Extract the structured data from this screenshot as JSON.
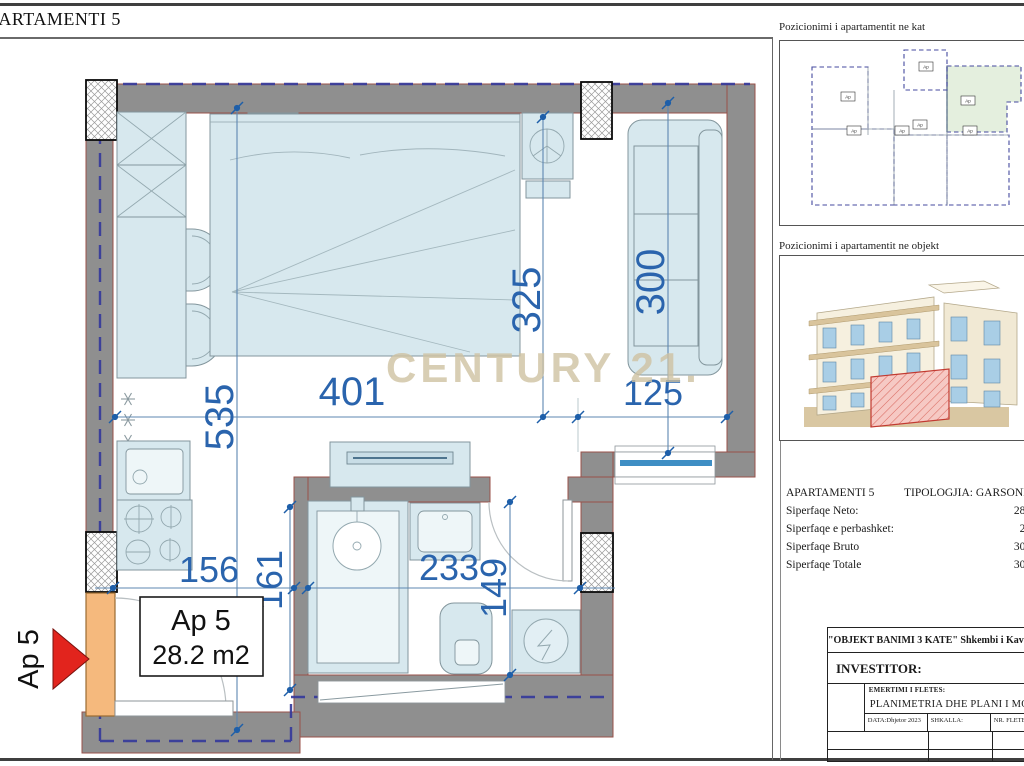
{
  "sheet": {
    "title": "APARTAMENTI 5"
  },
  "watermark": "CENTURY 21.",
  "colors": {
    "wall_gray": "#8f8f8f",
    "dimension_blue": "#2a64ad",
    "boundary_dash_blue": "#35399b",
    "door_orange": "#f5b97d",
    "arrow_red": "#e2241d",
    "furniture_blue": "#d7e8ee",
    "keyplan_highlight_green": "#e4efde",
    "object_highlight_red": "#c23a31",
    "watermark_tan": "#cfc2a2"
  },
  "plan": {
    "arrow_label": "Ap 5",
    "unit_box": {
      "name": "Ap 5",
      "area": "28.2 m2"
    },
    "dims": {
      "main_width": "401",
      "sofa_width": "125",
      "bed_height": "325",
      "sofa_height": "300",
      "kitchen_height": "535",
      "hall_width": "156",
      "hall_height": "161",
      "bath_width": "233",
      "bath_height": "149"
    }
  },
  "side_panel": {
    "key_plan_title": "Pozicionimi i apartamentit ne kat",
    "object_title": "Pozicionimi i apartamentit ne objekt",
    "unit_tag": "Ap"
  },
  "info": {
    "name": "APARTAMENTI 5",
    "typology": "TIPOLOGJIA: GARSONIE",
    "rows": [
      {
        "label": "Siperfaqe Neto:",
        "value": "28.2"
      },
      {
        "label": "Siperfaqe e perbashket:",
        "value": "2.1"
      },
      {
        "label": "Siperfaqe Bruto",
        "value": "30.3"
      },
      {
        "label": "Siperfaqe Totale",
        "value": "30.3"
      }
    ]
  },
  "title_block": {
    "project": "\"OBJEKT BANIMI 3 KATE\" Shkembi i Kavajes",
    "investor": "INVESTITOR:",
    "sheet_label": "EMERTIMI I FLETES:",
    "floor": "KATI P",
    "sheet_name": "PLANIMETRIA DHE PLANI I MOBILIMIT",
    "date": "DATA:Dhjetor 2023",
    "scale": "SHKALLA:",
    "number": "NR. FLETES:"
  }
}
